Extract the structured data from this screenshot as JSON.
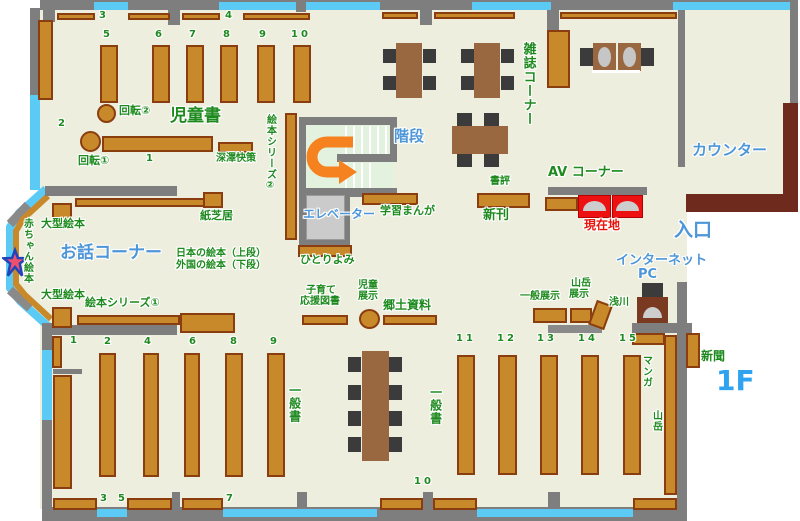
{
  "floor_label": "1F",
  "rooms": {
    "children_area": "児童書",
    "story_corner": "お話コーナー",
    "magazine_corner": "雑誌コーナー",
    "counter": "カウンター",
    "stairs": "階段",
    "elevator": "エレベーター",
    "av_corner": "AV コーナー",
    "you_are_here": "現在地",
    "entrance": "入口",
    "internet_pc_line1": "インターネット",
    "internet_pc_line2": "PC",
    "general_books_left": "一般書",
    "general_books_right": "一般書"
  },
  "shelf_labels": {
    "kaiten1": "回転①",
    "kaiten2": "回転②",
    "fukazawa": "深澤快策",
    "ehon_series2": "絵本シリーズ②",
    "ehon_series1": "絵本シリーズ①",
    "kamishibai": "紙芝居",
    "ogata_ehon_top": "大型絵本",
    "ogata_ehon_bottom": "大型絵本",
    "akachan_ehon": "赤ちゃん絵本",
    "nihon_no_ehon": "日本の絵本（上段）",
    "gaikoku_no_ehon": "外国の絵本（下段）",
    "hitoriyomi": "ひとりよみ",
    "gakushu_manga": "学習まんが",
    "shohyo": "書評",
    "shinkan": "新刊",
    "kosodate_line1": "子育て",
    "kosodate_line2": "応援図書",
    "jido_tenji_line1": "児童",
    "jido_tenji_line2": "展示",
    "kyodo_shiryo": "郷土資料",
    "ippan_tenji": "一般展示",
    "sangaku_tenji_line1": "山岳",
    "sangaku_tenji_line2": "展示",
    "asakawa": "浅川",
    "manga": "マンガ",
    "sangaku": "山岳",
    "shinbun": "新聞"
  },
  "numbers": {
    "top3": "3",
    "top4": "4",
    "child_shelves": [
      "5",
      "6",
      "7",
      "8",
      "9",
      "10"
    ],
    "child_side": "2",
    "child_center": "1",
    "bl_row": [
      "1",
      "2",
      "4",
      "6",
      "8",
      "9"
    ],
    "bb_row": [
      "3",
      "5",
      "7"
    ],
    "bottom_center": "10",
    "br_row": [
      "11",
      "12",
      "13",
      "14",
      "15"
    ]
  },
  "colors": {
    "floor": "#EEEEDF",
    "wall": "#7E7E7E",
    "window": "#5BCBF5",
    "shelf": "#C8892B",
    "shelf_border": "#8A3D0F",
    "label_green": "#1E8A1E",
    "label_blue": "#4D96D8",
    "label_red": "#E8150D",
    "highlight_red": "#EE1111",
    "counter_desk": "#6F2A1E",
    "arrow_orange": "#F5821E"
  }
}
